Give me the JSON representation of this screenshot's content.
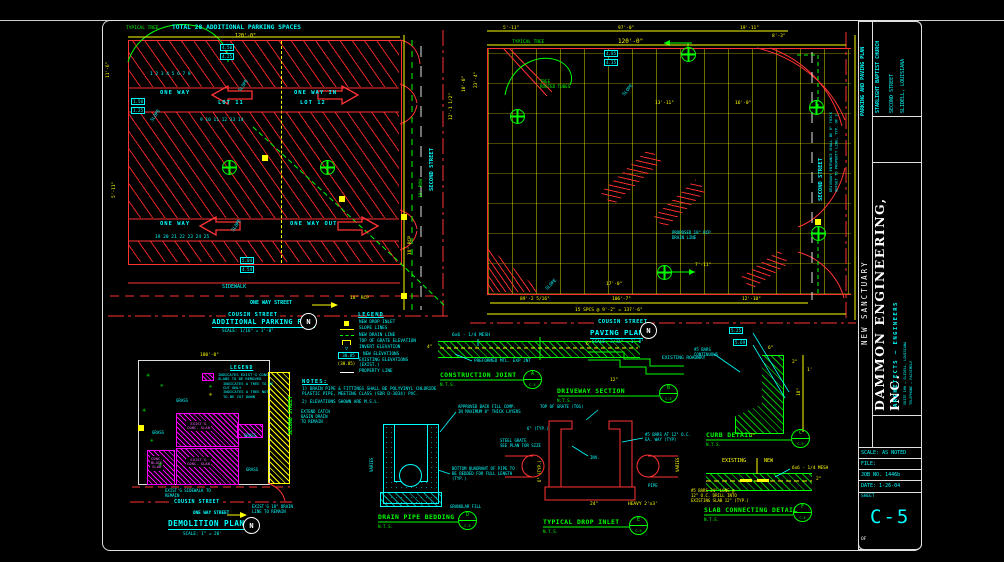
{
  "north_label": "N",
  "parking_plan": {
    "title": "TOTAL 28 ADDITIONAL PARKING SPACES",
    "top_dim": "120'-0\"",
    "stall_row_1": "1          2          3          4          5          6          7          8",
    "stall_row_2": "9            10            11            12            13            14",
    "stall_row_3": "19         20         21         22         23         24         25",
    "one_way": "ONE WAY",
    "lot11": "LOT 11",
    "one_way_in": "ONE WAY IN",
    "lot12": "LOT 12",
    "one_way_2": "ONE WAY",
    "one_way_out": "ONE WAY OUT",
    "sidewalk": "SIDEWALK",
    "one_way_street": "ONE WAY STREET",
    "cousin_street": "COUSIN STREET",
    "plan_title": "ADDITIONAL PARKING PLAN",
    "plan_scale": "SCALE: 1/16\" = 1'-0\""
  },
  "street": {
    "second_street": "SECOND STREET"
  },
  "paving_plan": {
    "top_dim": "120'-0\"",
    "cousin_street": "COUSIN STREET",
    "plan_title": "PAVING PLAN",
    "plan_scale": "SCALE: 3/32\" = 1'-0\"",
    "second_street": "SECOND STREET",
    "second_street_note": "DRIVEWAY ENTRANCE SHALL BE 6\" THICK\nOFFSET TO PROPERTY LINE, TYP. OF 3"
  },
  "legend": {
    "title": "LEGEND",
    "items": [
      {
        "sym": "sw-ysq",
        "label": "NEW DROP INLET"
      },
      {
        "sym": "sw-yline",
        "label": "SLOPE LINES"
      },
      {
        "sym": "sw-gdash",
        "label": "NEW DRAIN LINE"
      },
      {
        "sym": "sw-grate",
        "label": "TOP OF GRATE ELEVATION"
      },
      {
        "sym": "sw-invert",
        "sym_text": "▽",
        "label": "INVERT ELEVATION"
      },
      {
        "sym": "sw-box",
        "sym_text": "30.85",
        "label": "NEW ELEVATIONS"
      },
      {
        "sym": "sw-paren",
        "sym_text": "(30.85)",
        "label": "EXISTING ELEVATIONS\n(EXIST.)"
      },
      {
        "sym": "sw-wline",
        "label": "PROPERTY LINE"
      }
    ]
  },
  "notes": {
    "title": "NOTES:",
    "items": [
      "1)  DRAIN PIPE & FITTINGS SHALL BE POLYVINYL CHLORIDE\n     PLASTIC PIPE, MEETING CLASS (SDR D-3034) PVC.",
      "2)  ELEVATIONS SHOWN ARE M.S.L."
    ]
  },
  "demolition": {
    "legend_title": "LEGEND",
    "legend_items": [
      {
        "sym": "sw-mhatch",
        "label": "INDICATES EXIST'G CONC.\nSLABS TO BE REMOVED"
      },
      {
        "sym": "sw-gtree",
        "sym_text": "✳",
        "label": "INDICATES A TREE TO BE\nCUT ONLY"
      },
      {
        "sym": "sw-ytree",
        "sym_text": "✳",
        "label": "INDICATES A TREE NOT\nTO BE CUT DOWN"
      }
    ],
    "slab1": "EXIST'G\nCONC. SLAB",
    "slab2": "EXIST'G\nCONC. SLAB",
    "slab3": "CONC.\nBLOCK\nSLAB",
    "cousin_street": "COUSIN STREET",
    "one_way_street": "ONE WAY STREET",
    "title": "DEMOLITION PLAN",
    "scale": "SCALE: 1\" = 20'",
    "second_street": "SECOND STREET"
  },
  "details": {
    "sheet_ref": "C-5",
    "nts": "N.T.S.",
    "items": {
      "construction_joint": {
        "title": "CONSTRUCTION JOINT"
      },
      "driveway_section": {
        "title": "DRIVEWAY SECTION"
      },
      "curb_detail": {
        "title": "CURB DETAIL"
      },
      "drain_pipe_bedding": {
        "title": "DRAIN PIPE BEDDING"
      },
      "typical_drop_inlet": {
        "title": "TYPICAL DROP INLET"
      },
      "slab_connecting": {
        "title": "SLAB CONNECTING DETAIL"
      }
    }
  },
  "titleblock": {
    "project_type": "PARKING AND PAVING PLAN",
    "client": "STARLIGHT BAPTIST CHURCH",
    "client_addr1": "SECOND STREET",
    "client_addr2": "SLIDELL, LOUISIANA",
    "project": "NEW SANCTUARY",
    "firm": "DAMMON ENGINEERING, INC.",
    "firm_sub": "ARCHITECTS — ENGINEERS",
    "firm_addr1": "SUITE 100 — SLIDELL, LOUISIANA",
    "firm_addr2": "TELEPHONE — FACSIMILE",
    "scale_row": "SCALE: AS NOTED",
    "file_row": "FILE:",
    "job_row": "JOB NO. 1446b",
    "date_row": "DATE: 1-26-04",
    "sheet_label": "SHEET",
    "sheet_no": "C-5",
    "of_label": "OF"
  },
  "annotations": [
    {
      "t": "TYPICAL TREE",
      "x": 126,
      "y": 26,
      "c": "g",
      "s": 4.5
    },
    {
      "t": "11'-6\"",
      "x": 106,
      "y": 78,
      "c": "y",
      "s": 4.5,
      "r": -90
    },
    {
      "t": "5'-11\"",
      "x": 112,
      "y": 198,
      "c": "y",
      "s": 4.5,
      "r": -90
    },
    {
      "t": "SLOPE",
      "x": 238,
      "y": 90,
      "c": "c",
      "s": 4.5,
      "r": -55
    },
    {
      "t": "SLOPE",
      "x": 231,
      "y": 230,
      "c": "c",
      "s": 4.5,
      "r": -55
    },
    {
      "t": "SLOPE",
      "x": 150,
      "y": 120,
      "c": "c",
      "s": 4.5,
      "r": -55
    },
    {
      "t": "4.50",
      "x": 220,
      "y": 44,
      "c": "c",
      "s": 4.2,
      "box": 1
    },
    {
      "t": "4.25",
      "x": 220,
      "y": 53,
      "c": "c",
      "s": 4.2,
      "box": 1
    },
    {
      "t": "1.50",
      "x": 131,
      "y": 98,
      "c": "c",
      "s": 4.2,
      "box": 1
    },
    {
      "t": "1.25",
      "x": 131,
      "y": 107,
      "c": "c",
      "s": 4.2,
      "box": 1
    },
    {
      "t": "5.04",
      "x": 240,
      "y": 257,
      "c": "c",
      "s": 4.2,
      "box": 1
    },
    {
      "t": "4.54",
      "x": 240,
      "y": 266,
      "c": "c",
      "s": 4.2,
      "box": 1
    },
    {
      "t": "18\" RCP",
      "x": 350,
      "y": 296,
      "c": "y",
      "s": 4.5
    },
    {
      "t": "18\" RCP",
      "x": 408,
      "y": 255,
      "c": "y",
      "s": 4.5,
      "r": -90
    },
    {
      "t": "12'-1 1/2\"",
      "x": 449,
      "y": 120,
      "c": "y",
      "s": 4.5,
      "r": -90
    },
    {
      "t": "18' ROW",
      "x": 419,
      "y": 198,
      "c": "g",
      "s": 4.5,
      "r": -90
    },
    {
      "t": "10'-0\"",
      "x": 462,
      "y": 92,
      "c": "y",
      "s": 4.5,
      "r": -90
    },
    {
      "t": "5'-11\"",
      "x": 503,
      "y": 26,
      "c": "y",
      "s": 4.5
    },
    {
      "t": "97'-0\"",
      "x": 618,
      "y": 26,
      "c": "y",
      "s": 4.5
    },
    {
      "t": "19'-11\"",
      "x": 740,
      "y": 26,
      "c": "y",
      "s": 4.5
    },
    {
      "t": "8'-3\"",
      "x": 772,
      "y": 34,
      "c": "y",
      "s": 4.5
    },
    {
      "t": "TYPICAL TREE",
      "x": 512,
      "y": 40,
      "c": "g",
      "s": 4.5
    },
    {
      "t": "TREE\nROOTED TUBES",
      "x": 540,
      "y": 79,
      "c": "g",
      "s": 4.2
    },
    {
      "t": "23'-4\"",
      "x": 474,
      "y": 88,
      "c": "y",
      "s": 4.5,
      "r": -90
    },
    {
      "t": "13'-11\"",
      "x": 655,
      "y": 101,
      "c": "y",
      "s": 4.5
    },
    {
      "t": "16'-0\"",
      "x": 735,
      "y": 101,
      "c": "y",
      "s": 4.5
    },
    {
      "t": "7'-11\"",
      "x": 695,
      "y": 263,
      "c": "y",
      "s": 4.5
    },
    {
      "t": "17'-0\"",
      "x": 606,
      "y": 282,
      "c": "y",
      "s": 4.5
    },
    {
      "t": "SLOPE",
      "x": 622,
      "y": 94,
      "c": "c",
      "s": 4.5,
      "r": -50
    },
    {
      "t": "SLOPE",
      "x": 545,
      "y": 288,
      "c": "c",
      "s": 4.5,
      "r": -45
    },
    {
      "t": "4.85",
      "x": 604,
      "y": 50,
      "c": "c",
      "s": 4.2,
      "box": 1
    },
    {
      "t": "4.35",
      "x": 604,
      "y": 59,
      "c": "c",
      "s": 4.2,
      "box": 1
    },
    {
      "t": "89'-2 5/16\"",
      "x": 520,
      "y": 297,
      "c": "y",
      "s": 4.5
    },
    {
      "t": "106'-7\"",
      "x": 612,
      "y": 297,
      "c": "y",
      "s": 4.5
    },
    {
      "t": "12'-10\"",
      "x": 742,
      "y": 297,
      "c": "y",
      "s": 4.5
    },
    {
      "t": "15 SPCS @ 9'-2\" = 137'-6\"",
      "x": 575,
      "y": 308,
      "c": "y",
      "s": 4.5
    },
    {
      "t": "PROPOSED 18\" RCP\nDRAIN LINE",
      "x": 672,
      "y": 231,
      "c": "c",
      "s": 4
    },
    {
      "t": "180'-0\"",
      "x": 200,
      "y": 353,
      "c": "y",
      "s": 4.5
    },
    {
      "t": "6x6 - 1/4 MESH",
      "x": 452,
      "y": 333,
      "c": "c",
      "s": 4.5
    },
    {
      "t": "4\"",
      "x": 427,
      "y": 345,
      "c": "y",
      "s": 4.5
    },
    {
      "t": "PREFORMED MTL. EXP JNT",
      "x": 474,
      "y": 359,
      "c": "c",
      "s": 4.3
    },
    {
      "t": "EXISTING ROADWAY",
      "x": 662,
      "y": 356,
      "c": "c",
      "s": 4.5
    },
    {
      "t": "12\"",
      "x": 610,
      "y": 378,
      "c": "y",
      "s": 4.5
    },
    {
      "t": "6\"",
      "x": 586,
      "y": 342,
      "c": "y",
      "s": 4.5
    },
    {
      "t": "#5 BARS\nCONTINUOUS",
      "x": 694,
      "y": 348,
      "c": "c",
      "s": 4
    },
    {
      "t": "5.25",
      "x": 729,
      "y": 327,
      "c": "c",
      "s": 4.2,
      "box": 1
    },
    {
      "t": "5.69",
      "x": 733,
      "y": 339,
      "c": "c",
      "s": 4.2,
      "box": 1
    },
    {
      "t": "6\"",
      "x": 768,
      "y": 346,
      "c": "y",
      "s": 4.5
    },
    {
      "t": "2\"",
      "x": 792,
      "y": 360,
      "c": "y",
      "s": 4.5
    },
    {
      "t": "18\"",
      "x": 797,
      "y": 396,
      "c": "y",
      "s": 4.5,
      "r": -90
    },
    {
      "t": "7\"",
      "x": 750,
      "y": 434,
      "c": "y",
      "s": 4.5
    },
    {
      "t": "1'",
      "x": 807,
      "y": 368,
      "c": "y",
      "s": 4.5
    },
    {
      "t": "APPROVED BACK FILL COMP.\nIN MAXIMUM 8\" THICK LAYERS",
      "x": 458,
      "y": 405,
      "c": "c",
      "s": 4
    },
    {
      "t": "BOTTOM QUADRANT OF PIPE TO\nBE BEDDED FOR FULL LENGTH\n(TYP.)",
      "x": 452,
      "y": 467,
      "c": "c",
      "s": 4
    },
    {
      "t": "GRANULAR FILL",
      "x": 450,
      "y": 505,
      "c": "c",
      "s": 4
    },
    {
      "t": "VARIES",
      "x": 370,
      "y": 472,
      "c": "c",
      "s": 4,
      "r": -90
    },
    {
      "t": "TOP OF GRATE (TOG)",
      "x": 540,
      "y": 405,
      "c": "c",
      "s": 4
    },
    {
      "t": "6\" (TYP.)",
      "x": 527,
      "y": 427,
      "c": "c",
      "s": 4
    },
    {
      "t": "STEEL GRATE\nSEE PLAN FOR SIZE",
      "x": 500,
      "y": 439,
      "c": "c",
      "s": 4
    },
    {
      "t": "#5 BARS AT 12\" O.C.\nEA. WAY (TYP)",
      "x": 645,
      "y": 433,
      "c": "c",
      "s": 4
    },
    {
      "t": "INV.",
      "x": 590,
      "y": 456,
      "c": "c",
      "s": 4
    },
    {
      "t": "PIPE",
      "x": 648,
      "y": 484,
      "c": "c",
      "s": 4
    },
    {
      "t": "24\"",
      "x": 590,
      "y": 502,
      "c": "y",
      "s": 4.5
    },
    {
      "t": "HEAVY 2'x3'",
      "x": 628,
      "y": 502,
      "c": "y",
      "s": 4.5
    },
    {
      "t": "6\" (TYP.)",
      "x": 538,
      "y": 482,
      "c": "y",
      "s": 4,
      "r": -90
    },
    {
      "t": "VARIES",
      "x": 676,
      "y": 472,
      "c": "y",
      "s": 4,
      "r": -90
    },
    {
      "t": "EXISTING",
      "x": 722,
      "y": 458,
      "c": "y",
      "s": 5
    },
    {
      "t": "NEW",
      "x": 764,
      "y": 458,
      "c": "y",
      "s": 5
    },
    {
      "t": "6x6 - 1/4 MESH",
      "x": 792,
      "y": 466,
      "c": "y",
      "s": 4.3
    },
    {
      "t": "#5 BARS 24\" LONG @\n12\" O.C. DRILL INTO\nEXISTING SLAB 12\" (TYP.)",
      "x": 691,
      "y": 489,
      "c": "y",
      "s": 4
    },
    {
      "t": "2\"",
      "x": 816,
      "y": 477,
      "c": "y",
      "s": 4.5
    },
    {
      "t": "EXTEND CATCH\nBASIN DRAIN\nTO REMAIN",
      "x": 301,
      "y": 410,
      "c": "c",
      "s": 4
    },
    {
      "t": "GRASS",
      "x": 176,
      "y": 399,
      "c": "c",
      "s": 4
    },
    {
      "t": "GRASS",
      "x": 152,
      "y": 431,
      "c": "c",
      "s": 4
    },
    {
      "t": "GRASS",
      "x": 244,
      "y": 434,
      "c": "c",
      "s": 4
    },
    {
      "t": "GRASS",
      "x": 246,
      "y": 468,
      "c": "c",
      "s": 4
    },
    {
      "t": "EXIST'G SIDEWALK TO\nREMAIN",
      "x": 165,
      "y": 489,
      "c": "c",
      "s": 4
    },
    {
      "t": "EXIST'G 18\" DRAIN\nLINE TO REMAIN",
      "x": 252,
      "y": 505,
      "c": "c",
      "s": 4
    },
    {
      "t": "✳",
      "x": 146,
      "y": 371,
      "c": "g",
      "s": 7
    },
    {
      "t": "✳",
      "x": 160,
      "y": 382,
      "c": "g",
      "s": 6
    },
    {
      "t": "✳",
      "x": 142,
      "y": 406,
      "c": "g",
      "s": 7
    },
    {
      "t": "✳",
      "x": 150,
      "y": 437,
      "c": "g",
      "s": 6
    },
    {
      "t": "✳",
      "x": 158,
      "y": 460,
      "c": "g",
      "s": 7
    }
  ],
  "symbols": [
    {
      "type": "gcircle",
      "x": 222,
      "y": 160
    },
    {
      "type": "gcircle",
      "x": 320,
      "y": 160
    },
    {
      "type": "gcircle",
      "x": 681,
      "y": 47
    },
    {
      "type": "gcircle",
      "x": 510,
      "y": 109
    },
    {
      "type": "gcircle",
      "x": 657,
      "y": 265
    },
    {
      "type": "gcircle",
      "x": 809,
      "y": 100
    },
    {
      "type": "gcircle",
      "x": 811,
      "y": 226
    },
    {
      "type": "ysq",
      "x": 262,
      "y": 155
    },
    {
      "type": "ysq",
      "x": 339,
      "y": 196
    },
    {
      "type": "ysq",
      "x": 401,
      "y": 214
    },
    {
      "type": "ysq",
      "x": 401,
      "y": 293
    },
    {
      "type": "ysq",
      "x": 815,
      "y": 219
    },
    {
      "type": "ysq",
      "x": 138,
      "y": 425
    },
    {
      "type": "north",
      "x": 300,
      "y": 313
    },
    {
      "type": "north",
      "x": 640,
      "y": 322
    },
    {
      "type": "north",
      "x": 243,
      "y": 517
    },
    {
      "type": "marker",
      "l": "A",
      "x": 523,
      "y": 370
    },
    {
      "type": "marker",
      "l": "B",
      "x": 659,
      "y": 384
    },
    {
      "type": "marker",
      "l": "C",
      "x": 791,
      "y": 429
    },
    {
      "type": "marker",
      "l": "D",
      "x": 458,
      "y": 511
    },
    {
      "type": "marker",
      "l": "E",
      "x": 629,
      "y": 516
    },
    {
      "type": "marker",
      "l": "F",
      "x": 793,
      "y": 503
    }
  ]
}
